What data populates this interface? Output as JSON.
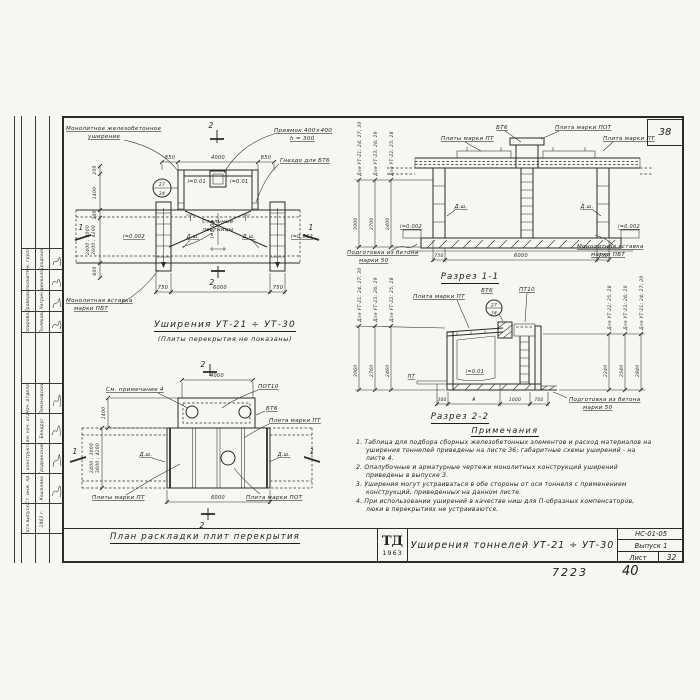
{
  "corner_sheet_number": "38",
  "footer": {
    "doc_number": "7223",
    "page_number": "40"
  },
  "title_block": {
    "logo_top": "ТД",
    "logo_year": "1963",
    "title": "Уширения тоннелей УТ-21 ÷ УТ-30",
    "code": "НС-01-05",
    "issue": "Выпуск 1",
    "sheet_label": "Лист",
    "sheet_number": "32"
  },
  "stamp": {
    "upper_rows": [
      {
        "role": "Рук. группы",
        "name": "Бродский"
      },
      {
        "role": "Исполнитель",
        "name": "Единколов"
      },
      {
        "role": "Проверил",
        "name": "Чагрин"
      },
      {
        "role": "Копировала",
        "name": "Полякова"
      }
    ],
    "lower_rows": [
      {
        "role": "Нач. отдела",
        "name": "Ламановский"
      },
      {
        "role": "Зам. нач. отд.",
        "name": "Бендрус"
      },
      {
        "role": "Гл. конструктор",
        "name": "Гродзинский"
      },
      {
        "role": "Ст. инж. пр.",
        "name": "Кошелева"
      },
      {
        "role": "Дата выпуска",
        "name": "1963 г."
      }
    ]
  },
  "plan": {
    "caption": "Уширения УТ-21 ÷ УТ-30",
    "subcaption": "(Плиты перекрытия не показаны)",
    "labels": {
      "widening_1": "Монолитное железобетонное",
      "widening_2": "уширение",
      "pit_1": "Приямок 400×400",
      "pit_2": "h = 300",
      "socket": "Гнездо для БТ6",
      "stairs_1": "Стальные",
      "stairs_2": "лестницы",
      "insert_1": "Монолитная вставка",
      "insert_2": "марки ПБТ",
      "slope_01": "i=0.01",
      "slope_002": "i=0.002",
      "joint": "Д.ш."
    },
    "detail_circle": {
      "top": "27",
      "bottom": "34"
    },
    "dims": {
      "top": [
        "850",
        "4000",
        "850"
      ],
      "bottom": [
        "750",
        "6000",
        "750"
      ],
      "left": [
        "200",
        "1400",
        "300",
        "600"
      ],
      "left_stack_1": "2400 ; 3000",
      "left_stack_2": "3600 ; 4200"
    },
    "marks": {
      "v": "2",
      "h": "1"
    }
  },
  "section1": {
    "caption": "Разрез 1-1",
    "labels": {
      "bt6": "БТ6",
      "slab_pot": "Плита марки ПОТ",
      "slabs_pt": "Плиты марки ПТ",
      "slab_pt": "Плита марки ПТ",
      "base_1": "Подготовка из бетона",
      "base_2": "марки 50",
      "insert_1": "Монолитная вставка",
      "insert_2": "марки ПБТ",
      "joint": "Д.ш.",
      "slope": "i=0.002"
    },
    "height_cols": [
      {
        "group": "Для УТ-21; 24; 27; 30",
        "value": "3000"
      },
      {
        "group": "Для УТ-23; 26; 29",
        "value": "2700"
      },
      {
        "group": "Для УТ-22; 25; 28",
        "value": "2400"
      }
    ],
    "dims_bottom": [
      "750",
      "6000",
      "750"
    ]
  },
  "section2": {
    "caption": "Разрез 2-2",
    "labels": {
      "slab_pt": "Плита марки ПТ",
      "bt6": "БТ6",
      "pt10": "ПТ10",
      "pt": "ПТ",
      "slope": "i=0.01",
      "base_1": "Подготовка из бетона",
      "base_2": "марки 50"
    },
    "detail_circle": {
      "top": "27",
      "bottom": "34"
    },
    "left_cols": [
      {
        "group": "Для УТ-21; 24; 27; 30",
        "value": "3060"
      },
      {
        "group": "Для УТ-23; 26; 29",
        "value": "2760"
      },
      {
        "group": "Для УТ-22; 25; 28",
        "value": "2460"
      }
    ],
    "right_cols": [
      {
        "group": "Для УТ-22; 25; 28",
        "value": "2240"
      },
      {
        "group": "Для УТ-23; 26; 29",
        "value": "2540"
      },
      {
        "group": "Для УТ-21; 24; 27; 30",
        "value": "2840"
      }
    ],
    "dims_bottom": [
      "300",
      "А",
      "1000",
      "700"
    ]
  },
  "layout_plan": {
    "caption": "План раскладки плит перекрытия",
    "labels": {
      "see_note": "См. примечание 4",
      "pot10": "ПОТ10",
      "bt6": "БТ6",
      "slab_pt": "Плита марки ПТ",
      "slabs_pt": "Плиты марки ПТ",
      "slab_pot": "Плита марки ПОТ",
      "joint": "Д.ш."
    },
    "dims": {
      "top": "4000",
      "bottom": "6000",
      "left_upper": "1400",
      "left_stack_1": "2400 ; 3000",
      "left_stack_2": "3600 ; 4200"
    },
    "marks": {
      "v": "2",
      "h": "1"
    }
  },
  "notes": {
    "heading": "Примечания",
    "items": [
      "1. Таблица для подбора сборных железобетонных элементов и расход материалов на уширения тоннелей приведены на листе 36; габаритные схемы уширений - на листе 4.",
      "2. Опалубочные и арматурные чертежи монолитных конструкций уширений приведены в выпуске 3.",
      "3. Уширения могут устраиваться в обе стороны от оси тоннеля с применением конструкций, приведенных на данном листе.",
      "4. При использовании уширений в качестве ниш для П-образных компенсаторов, люки в перекрытиях не устраиваются."
    ]
  }
}
